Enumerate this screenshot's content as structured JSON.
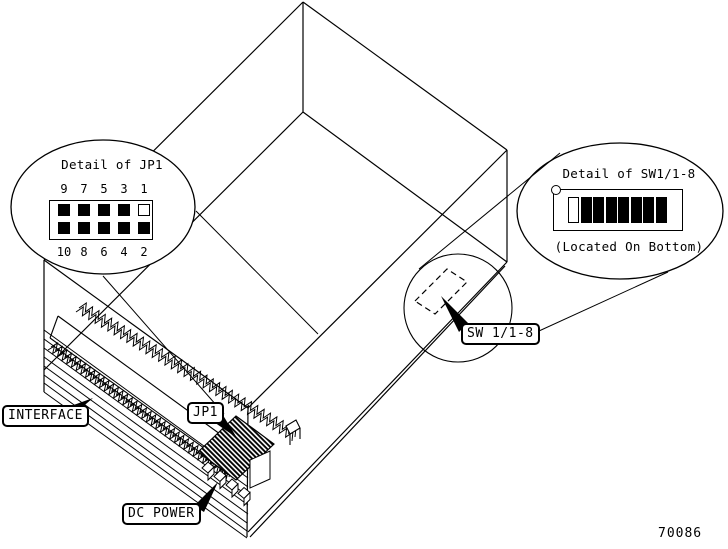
{
  "figure_number": "70086",
  "colors": {
    "line": "#000000",
    "background": "#ffffff"
  },
  "jp1_detail": {
    "title": "Detail of JP1",
    "top_pin_numbers": [
      "9",
      "7",
      "5",
      "3",
      "1"
    ],
    "bottom_pin_numbers": [
      "10",
      "8",
      "6",
      "4",
      "2"
    ],
    "top_pin_states": [
      "filled",
      "filled",
      "filled",
      "filled",
      "open"
    ],
    "bottom_pin_states": [
      "filled",
      "filled",
      "filled",
      "filled",
      "filled"
    ]
  },
  "sw1_detail": {
    "title": "Detail of SW1/1-8",
    "note": "(Located On Bottom)",
    "switch_states": [
      "open",
      "filled",
      "filled",
      "filled",
      "filled",
      "filled",
      "filled",
      "filled"
    ]
  },
  "labels": {
    "interface": "INTERFACE",
    "jp1": "JP1",
    "dc_power": "DC POWER",
    "sw1": "SW 1/1-8"
  }
}
